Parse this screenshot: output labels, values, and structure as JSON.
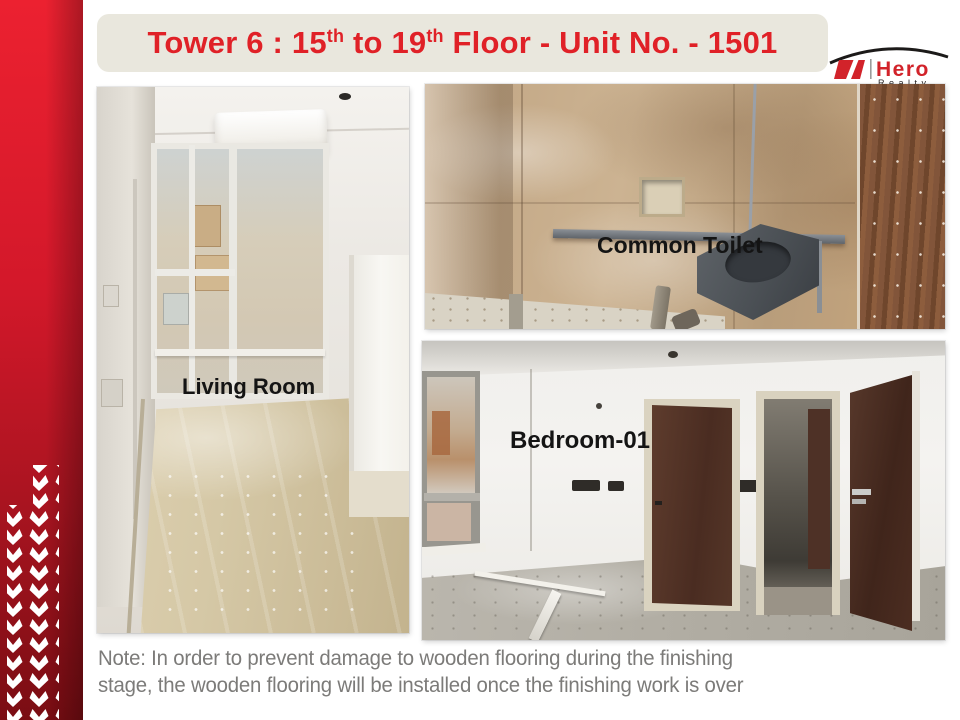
{
  "slide": {
    "title": {
      "part1": "Tower 6 : 15",
      "sup1": "th",
      "part2": " to 19",
      "sup2": "th",
      "part3": " Floor - Unit No. - 1501"
    },
    "logo": {
      "brand": "Hero",
      "subbrand": "Realty"
    },
    "photos": {
      "living_room": {
        "label": "Living Room"
      },
      "common_toilet": {
        "label": "Common Toilet"
      },
      "bedroom": {
        "label": "Bedroom-01"
      }
    },
    "note": {
      "line1": "Note: In order to prevent damage to wooden flooring during the finishing",
      "line2": "stage, the wooden flooring will be installed once the finishing work is over"
    },
    "colors": {
      "accent_red": "#e02127",
      "sidebar_red_top": "#ec2130",
      "sidebar_red_bottom": "#7a0d13",
      "title_bar_bg": "#e9e7dd",
      "note_gray": "#7c7b79",
      "label_black": "#141414"
    }
  }
}
